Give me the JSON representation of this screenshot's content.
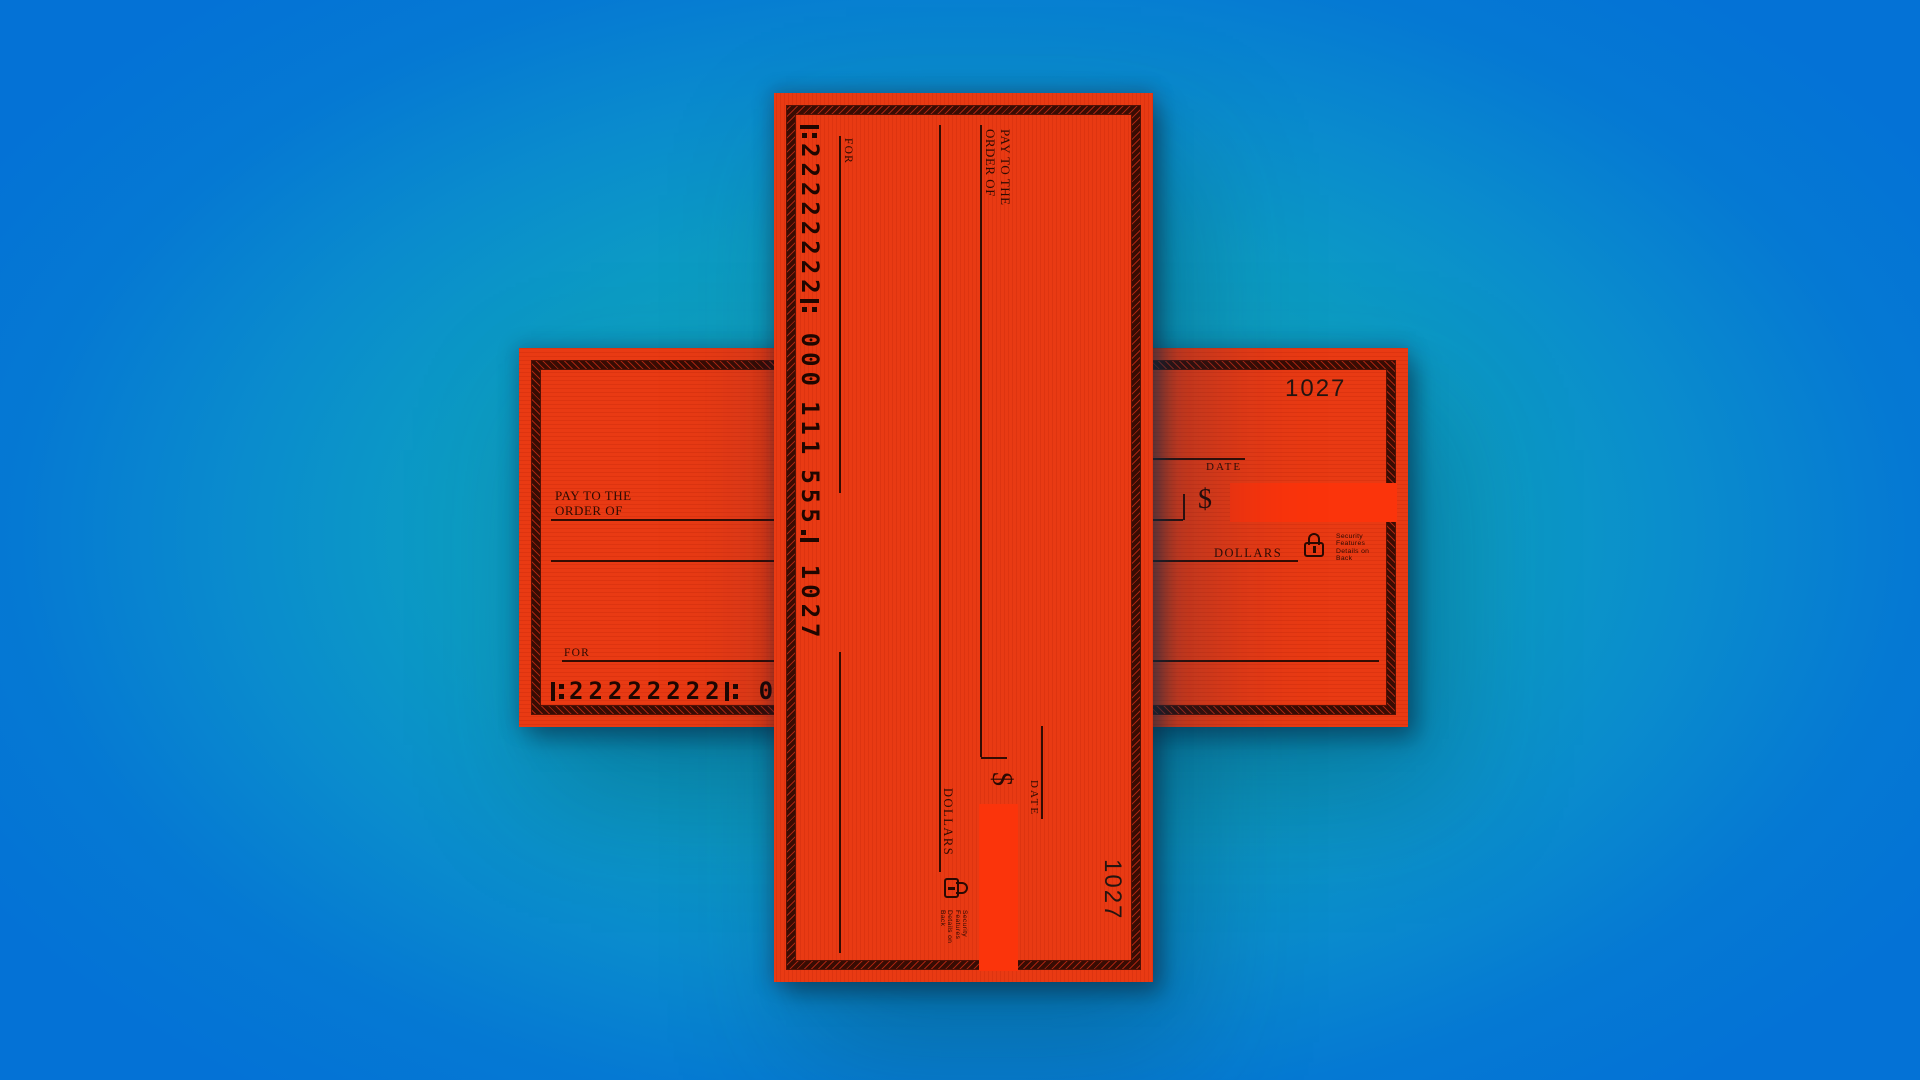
{
  "palette": {
    "background_center": "#14adc3",
    "background_edge": "#0476d5",
    "check_paper": "#e93a13",
    "amount_box": "#fb340b",
    "ink": "#2e0b02"
  },
  "check": {
    "number": "1027",
    "labels": {
      "pay_to_line1": "PAY TO THE",
      "pay_to_line2": "ORDER OF",
      "date": "DATE",
      "currency": "$",
      "dollars": "DOLLARS",
      "memo": "FOR",
      "security": [
        "Security",
        "Features",
        "Details on",
        "Back"
      ]
    },
    "micr": {
      "routing": "22222222",
      "account_groups": [
        "000",
        "111",
        "555"
      ],
      "check_number": "1027"
    }
  }
}
